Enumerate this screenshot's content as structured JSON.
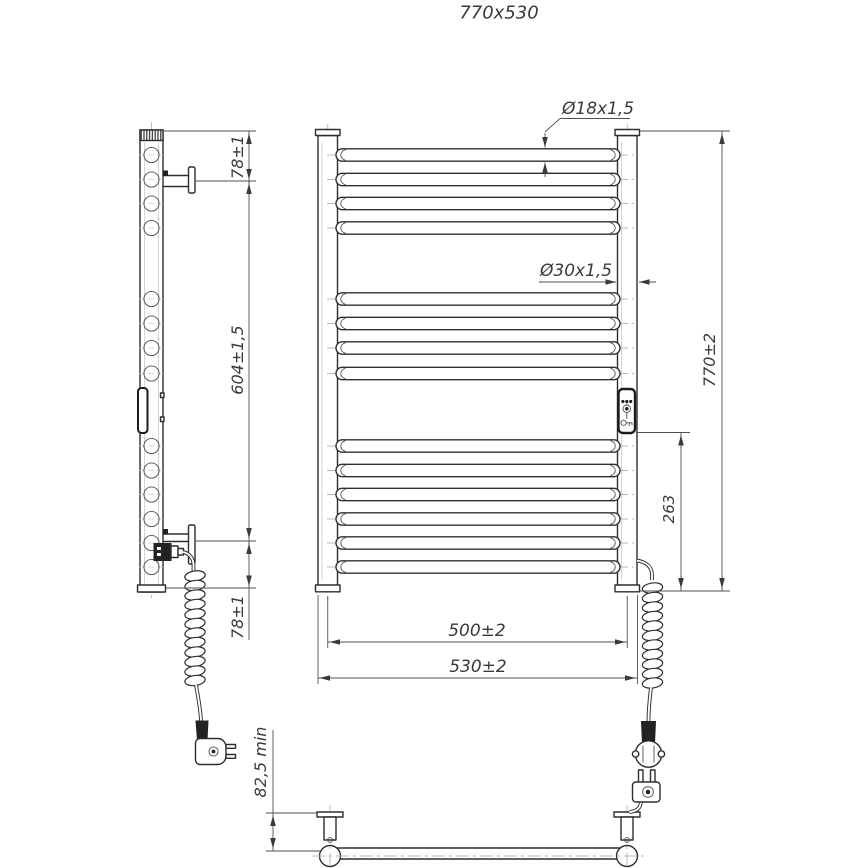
{
  "drawing": {
    "title": "770x530"
  },
  "dimensions": {
    "top_bracket_offset": "78±1",
    "mounting_span": "604±1,5",
    "bottom_bracket_offset": "78±1",
    "wall_distance_min": "82,5 min",
    "bar_tube": "Ø18x1,5",
    "post_tube": "Ø30x1,5",
    "overall_height": "770±2",
    "cable_outlet_offset": "263",
    "mounting_width": "500±2",
    "overall_width": "530±2"
  }
}
